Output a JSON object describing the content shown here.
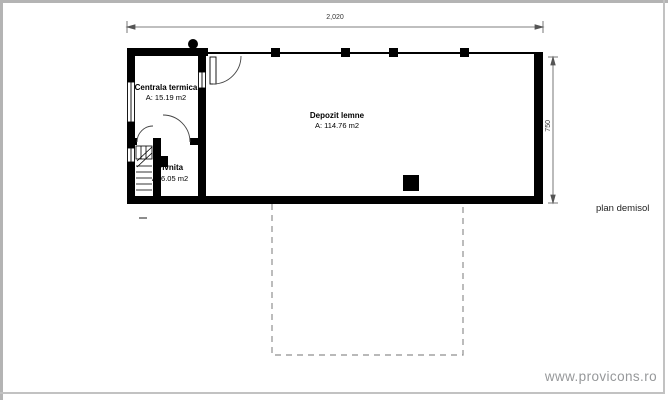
{
  "plan": {
    "caption": "plan demisol",
    "dimensions": {
      "width": "2,020",
      "height": "750"
    },
    "rooms": {
      "centrala": {
        "name": "Centrala termica",
        "area": "A: 15.19 m2"
      },
      "pivnita": {
        "name": "Pivnita",
        "area": "A: 6.05 m2"
      },
      "depozit": {
        "name": "Depozit lemne",
        "area": "A: 114.76 m2"
      }
    }
  },
  "watermark": "www.provicons.ro",
  "colors": {
    "wall": "#000000",
    "dashed_outline": "#8f8f8f",
    "page_frame": "#b4b4b4",
    "watermark_text": "#96989a"
  }
}
